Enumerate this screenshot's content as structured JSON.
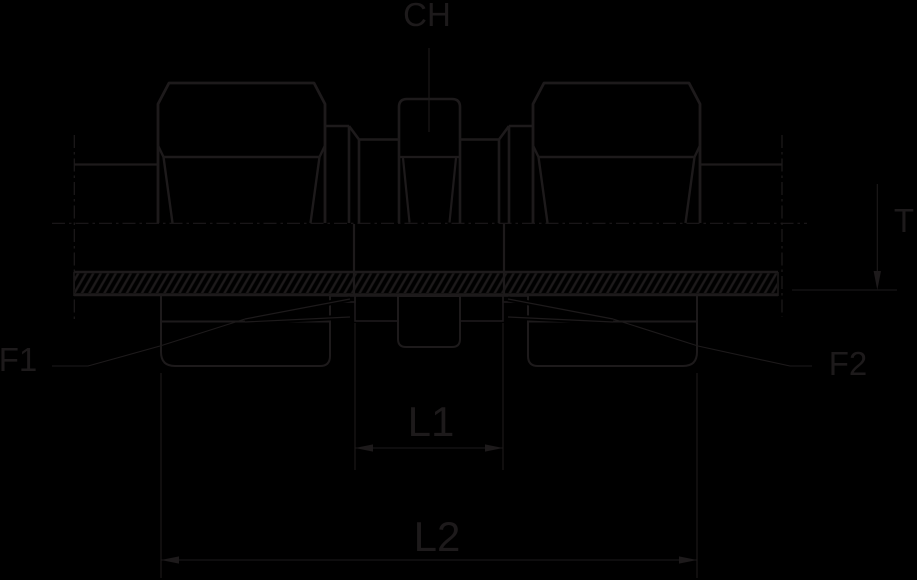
{
  "drawing": {
    "type": "technical-dimensional-drawing",
    "subject": "bulkhead-tube-fitting-side-view-with-panel-section",
    "labels": {
      "ch": "CH",
      "t": "T",
      "f1": "F1",
      "f2": "F2",
      "l1": "L1",
      "l2": "L2"
    },
    "colors": {
      "background": "#000000",
      "ink": "#1d1a1b"
    }
  }
}
